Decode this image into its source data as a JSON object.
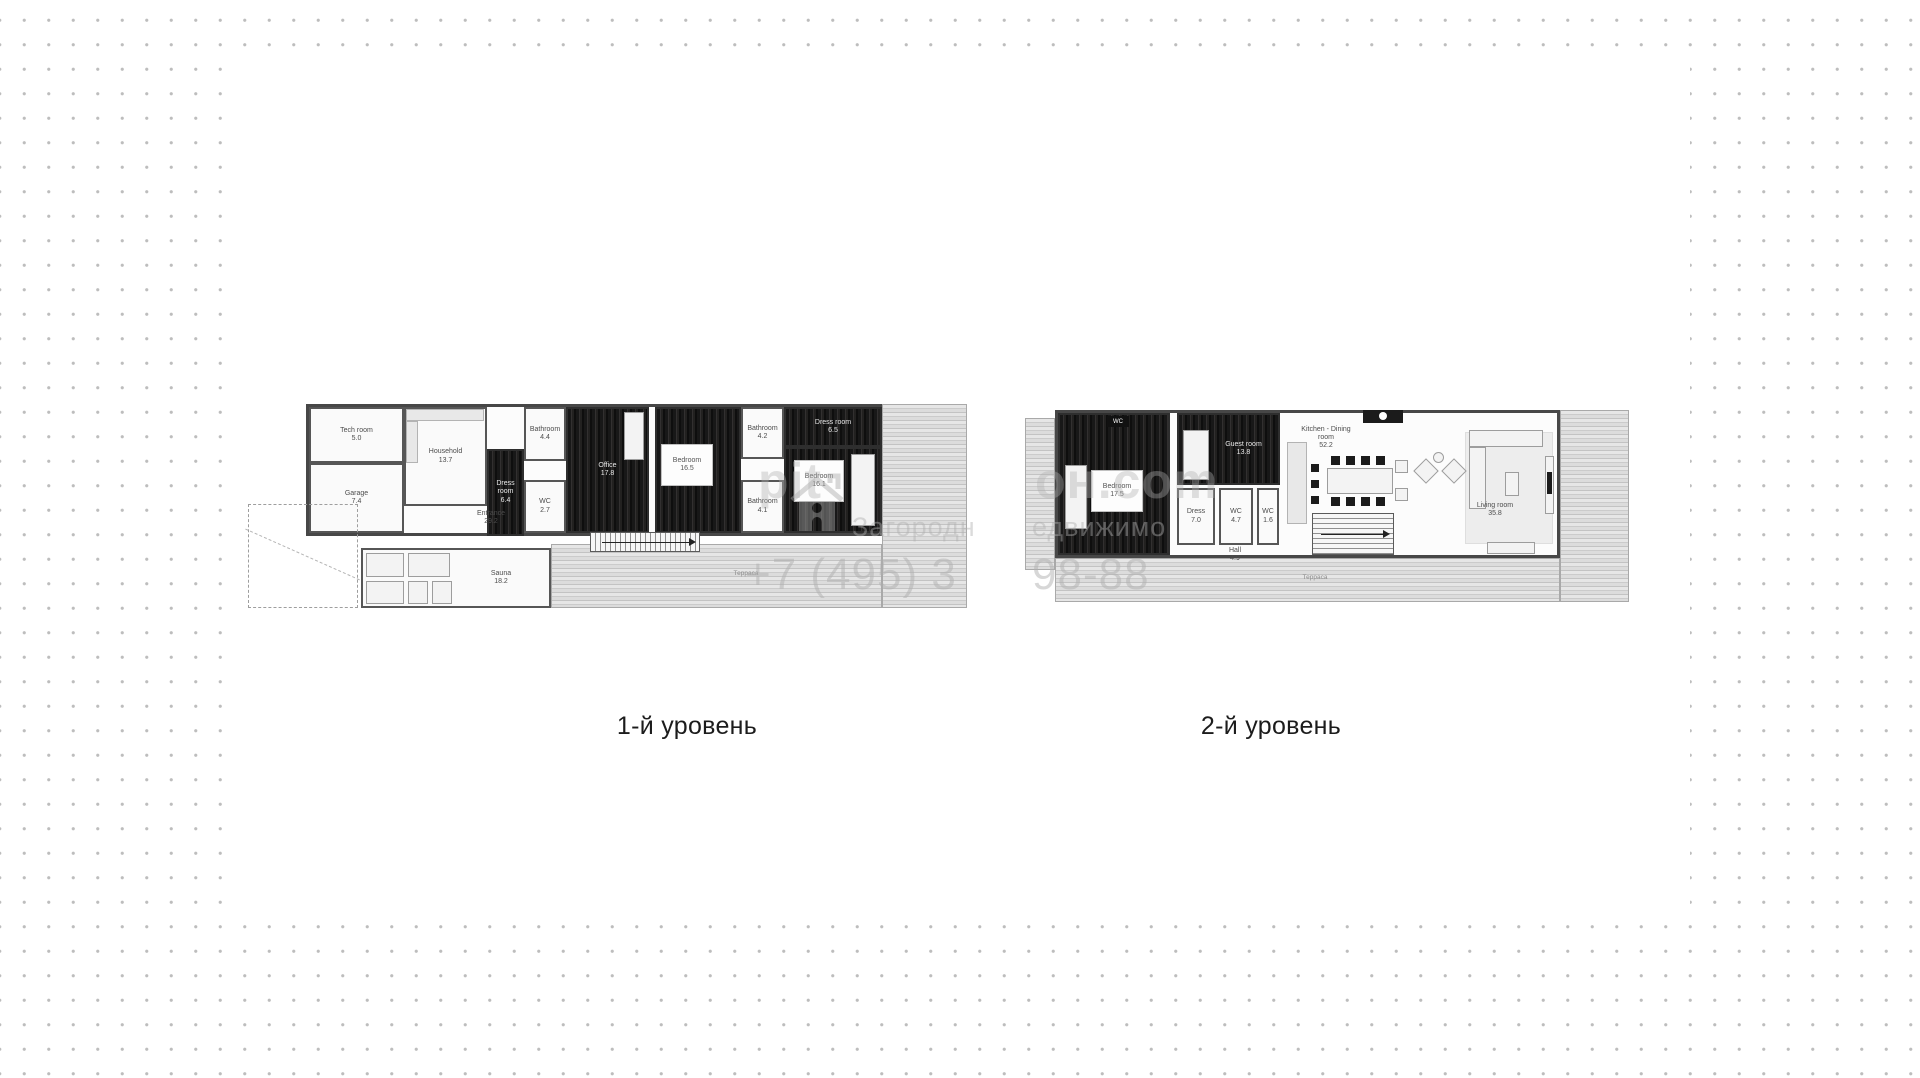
{
  "page": {
    "dot_color": "#bdbdbd",
    "card_color": "#ffffff",
    "card": {
      "x": 235,
      "y": 67,
      "w": 1455,
      "h": 858
    }
  },
  "levels": [
    {
      "label": "1-й уровень",
      "label_x": 687,
      "label_y": 712,
      "x": 306,
      "y": 404,
      "w": 661,
      "h": 206,
      "elements": [
        {
          "kind": "room",
          "style": "base",
          "x": 0,
          "y": 0,
          "w": 576,
          "h": 132,
          "name": "house-outline"
        },
        {
          "kind": "room",
          "style": "deck",
          "x": 576,
          "y": 0,
          "w": 85,
          "h": 204,
          "name": "terrace-right"
        },
        {
          "kind": "room",
          "style": "deck",
          "x": 245,
          "y": 140,
          "w": 331,
          "h": 64,
          "name": "terrace-bottom"
        },
        {
          "kind": "room",
          "style": "light",
          "x": 3,
          "y": 3,
          "w": 95,
          "h": 56,
          "label": "Tech room",
          "area": "5.0"
        },
        {
          "kind": "room",
          "style": "light",
          "x": 3,
          "y": 59,
          "w": 95,
          "h": 70,
          "label": "Garage",
          "area": "7.4"
        },
        {
          "kind": "room",
          "style": "light",
          "x": 98,
          "y": 3,
          "w": 83,
          "h": 99,
          "label": "Household",
          "area": "13.7"
        },
        {
          "kind": "furn",
          "shape": "counter",
          "x": 100,
          "y": 5,
          "w": 78,
          "h": 12
        },
        {
          "kind": "furn",
          "shape": "counter",
          "x": 100,
          "y": 17,
          "w": 12,
          "h": 42
        },
        {
          "kind": "room",
          "style": "dark",
          "x": 181,
          "y": 45,
          "w": 37,
          "h": 87,
          "label": "Dress room",
          "area": "6.4"
        },
        {
          "kind": "room",
          "style": "light",
          "x": 218,
          "y": 3,
          "w": 42,
          "h": 54,
          "label": "Bathroom",
          "area": "4.4"
        },
        {
          "kind": "room",
          "style": "light",
          "x": 218,
          "y": 76,
          "w": 42,
          "h": 53,
          "label": "WC",
          "area": "2.7"
        },
        {
          "kind": "room",
          "style": "dark",
          "x": 260,
          "y": 3,
          "w": 83,
          "h": 126,
          "label": "Office",
          "area": "17.8"
        },
        {
          "kind": "furn",
          "shape": "rect",
          "x": 318,
          "y": 8,
          "w": 20,
          "h": 48
        },
        {
          "kind": "room",
          "style": "dark",
          "x": 349,
          "y": 3,
          "w": 86,
          "h": 126,
          "name": "room-bedroom-2"
        },
        {
          "kind": "furn",
          "shape": "labelbox",
          "x": 355,
          "y": 40,
          "w": 52,
          "h": 42,
          "label": "Bedroom",
          "area": "16.5"
        },
        {
          "kind": "room",
          "style": "light",
          "x": 435,
          "y": 3,
          "w": 43,
          "h": 52,
          "label": "Bathroom",
          "area": "4.2"
        },
        {
          "kind": "room",
          "style": "light",
          "x": 435,
          "y": 76,
          "w": 43,
          "h": 53,
          "label": "Bathroom",
          "area": "4.1"
        },
        {
          "kind": "room",
          "style": "dark",
          "x": 478,
          "y": 3,
          "w": 98,
          "h": 40,
          "label": "Dress room",
          "area": "6.5"
        },
        {
          "kind": "room",
          "style": "dark",
          "x": 478,
          "y": 43,
          "w": 98,
          "h": 86,
          "name": "room-bedroom-1"
        },
        {
          "kind": "furn",
          "shape": "rect",
          "x": 545,
          "y": 50,
          "w": 24,
          "h": 72
        },
        {
          "kind": "furn",
          "shape": "labelbox",
          "x": 488,
          "y": 56,
          "w": 50,
          "h": 42,
          "label": "Bedroom",
          "area": "16.1"
        },
        {
          "kind": "label",
          "label": "Entrance",
          "area": "29.2",
          "x": 150,
          "y": 106,
          "w": 70
        },
        {
          "kind": "stairs",
          "dir": "v",
          "x": 284,
          "y": 128,
          "w": 110,
          "h": 20
        },
        {
          "kind": "room",
          "style": "light",
          "x": 55,
          "y": 144,
          "w": 190,
          "h": 60,
          "label": "Sauna",
          "area": "18.2",
          "pad": 90,
          "name": "room-sauna"
        },
        {
          "kind": "furn",
          "shape": "rect",
          "x": 60,
          "y": 149,
          "w": 38,
          "h": 24
        },
        {
          "kind": "furn",
          "shape": "rect",
          "x": 60,
          "y": 177,
          "w": 38,
          "h": 23
        },
        {
          "kind": "furn",
          "shape": "rect",
          "x": 102,
          "y": 149,
          "w": 42,
          "h": 24
        },
        {
          "kind": "furn",
          "shape": "rect",
          "x": 102,
          "y": 177,
          "w": 20,
          "h": 23
        },
        {
          "kind": "furn",
          "shape": "rect",
          "x": 126,
          "y": 177,
          "w": 20,
          "h": 23
        },
        {
          "kind": "dashed",
          "x": -58,
          "y": 100,
          "w": 110,
          "h": 104,
          "name": "driveway-outline"
        },
        {
          "kind": "zone-label",
          "label": "Терраса",
          "x": 400,
          "y": 166,
          "w": 80
        }
      ]
    },
    {
      "label": "2-й уровень",
      "label_x": 1271,
      "label_y": 712,
      "x": 1025,
      "y": 410,
      "w": 604,
      "h": 200,
      "elements": [
        {
          "kind": "room",
          "style": "deck",
          "x": 0,
          "y": 8,
          "w": 30,
          "h": 152,
          "name": "deck-left"
        },
        {
          "kind": "room",
          "style": "base",
          "x": 30,
          "y": 0,
          "w": 505,
          "h": 148,
          "name": "house-outline"
        },
        {
          "kind": "room",
          "style": "deck",
          "x": 535,
          "y": 0,
          "w": 69,
          "h": 192,
          "name": "deck-right"
        },
        {
          "kind": "room",
          "style": "deck",
          "x": 30,
          "y": 148,
          "w": 505,
          "h": 44,
          "name": "terrace-bottom"
        },
        {
          "kind": "room",
          "style": "dark",
          "x": 33,
          "y": 3,
          "w": 112,
          "h": 142,
          "name": "room-bedroom"
        },
        {
          "kind": "furn",
          "shape": "rect",
          "x": 40,
          "y": 55,
          "w": 22,
          "h": 64
        },
        {
          "kind": "furn",
          "shape": "labelbox",
          "x": 66,
          "y": 60,
          "w": 52,
          "h": 42,
          "label": "Bedroom",
          "area": "17.5"
        },
        {
          "kind": "tag",
          "label": "WC",
          "x": 82,
          "y": 6,
          "w": 22,
          "h": 11
        },
        {
          "kind": "room",
          "style": "dark",
          "x": 152,
          "y": 3,
          "w": 103,
          "h": 72,
          "label": "Guest room",
          "area": "13.8",
          "pad": 30
        },
        {
          "kind": "furn",
          "shape": "rect",
          "x": 158,
          "y": 20,
          "w": 26,
          "h": 50
        },
        {
          "kind": "room",
          "style": "light",
          "x": 152,
          "y": 78,
          "w": 38,
          "h": 57,
          "label": "Dress",
          "area": "7.0"
        },
        {
          "kind": "room",
          "style": "light",
          "x": 194,
          "y": 78,
          "w": 34,
          "h": 57,
          "label": "WC",
          "area": "4.7"
        },
        {
          "kind": "room",
          "style": "light",
          "x": 232,
          "y": 78,
          "w": 22,
          "h": 57,
          "label": "WC",
          "area": "1.6"
        },
        {
          "kind": "label",
          "label": "Hall",
          "area": "4.9",
          "x": 185,
          "y": 137,
          "w": 50
        },
        {
          "kind": "label",
          "label": "Kitchen - Dining room",
          "area": "52.2",
          "x": 268,
          "y": 16,
          "w": 66,
          "name": "label-kitchen-dining-room"
        },
        {
          "kind": "furn",
          "shape": "counter",
          "x": 262,
          "y": 32,
          "w": 20,
          "h": 82
        },
        {
          "kind": "furn",
          "shape": "black",
          "x": 286,
          "y": 54,
          "w": 8,
          "h": 8
        },
        {
          "kind": "furn",
          "shape": "black",
          "x": 286,
          "y": 70,
          "w": 8,
          "h": 8
        },
        {
          "kind": "furn",
          "shape": "black",
          "x": 286,
          "y": 86,
          "w": 8,
          "h": 8
        },
        {
          "kind": "furn",
          "shape": "rect",
          "x": 302,
          "y": 58,
          "w": 66,
          "h": 26
        },
        {
          "kind": "furn",
          "shape": "black",
          "x": 306,
          "y": 46,
          "w": 9,
          "h": 9
        },
        {
          "kind": "furn",
          "shape": "black",
          "x": 321,
          "y": 46,
          "w": 9,
          "h": 9
        },
        {
          "kind": "furn",
          "shape": "black",
          "x": 336,
          "y": 46,
          "w": 9,
          "h": 9
        },
        {
          "kind": "furn",
          "shape": "black",
          "x": 351,
          "y": 46,
          "w": 9,
          "h": 9
        },
        {
          "kind": "furn",
          "shape": "black",
          "x": 306,
          "y": 87,
          "w": 9,
          "h": 9
        },
        {
          "kind": "furn",
          "shape": "black",
          "x": 321,
          "y": 87,
          "w": 9,
          "h": 9
        },
        {
          "kind": "furn",
          "shape": "black",
          "x": 336,
          "y": 87,
          "w": 9,
          "h": 9
        },
        {
          "kind": "furn",
          "shape": "black",
          "x": 351,
          "y": 87,
          "w": 9,
          "h": 9
        },
        {
          "kind": "furn",
          "shape": "rect",
          "x": 370,
          "y": 50,
          "w": 13,
          "h": 13
        },
        {
          "kind": "furn",
          "shape": "rect",
          "x": 370,
          "y": 78,
          "w": 13,
          "h": 13
        },
        {
          "kind": "furn",
          "shape": "black",
          "x": 338,
          "y": 0,
          "w": 40,
          "h": 13,
          "name": "fireplace"
        },
        {
          "kind": "furn",
          "shape": "rwhite",
          "x": 354,
          "y": 2,
          "w": 8,
          "h": 8
        },
        {
          "kind": "furn",
          "shape": "rot",
          "x": 392,
          "y": 52,
          "w": 18,
          "h": 18
        },
        {
          "kind": "furn",
          "shape": "rot",
          "x": 420,
          "y": 52,
          "w": 18,
          "h": 18
        },
        {
          "kind": "furn",
          "shape": "round",
          "x": 408,
          "y": 42,
          "w": 11,
          "h": 11
        },
        {
          "kind": "stairs",
          "dir": "h",
          "x": 287,
          "y": 103,
          "w": 82,
          "h": 42
        },
        {
          "kind": "furn",
          "shape": "rug",
          "x": 440,
          "y": 22,
          "w": 88,
          "h": 112
        },
        {
          "kind": "furn",
          "shape": "rect",
          "x": 444,
          "y": 20,
          "w": 74,
          "h": 17
        },
        {
          "kind": "furn",
          "shape": "rect",
          "x": 444,
          "y": 37,
          "w": 17,
          "h": 62
        },
        {
          "kind": "furn",
          "shape": "rect",
          "x": 480,
          "y": 62,
          "w": 14,
          "h": 24
        },
        {
          "kind": "furn",
          "shape": "rect",
          "x": 520,
          "y": 46,
          "w": 9,
          "h": 58
        },
        {
          "kind": "furn",
          "shape": "black",
          "x": 522,
          "y": 62,
          "w": 5,
          "h": 22
        },
        {
          "kind": "furn",
          "shape": "rect",
          "x": 462,
          "y": 132,
          "w": 48,
          "h": 12
        },
        {
          "kind": "label",
          "label": "Living room",
          "area": "35.8",
          "x": 440,
          "y": 92,
          "w": 60
        },
        {
          "kind": "zone-label",
          "label": "Терраса",
          "x": 250,
          "y": 164,
          "w": 80
        }
      ]
    }
  ],
  "watermark": {
    "logo_icon": "house-logo-icon",
    "fragments": [
      {
        "text": "pit",
        "x": 758,
        "y": 452,
        "size": 50,
        "weight": 700,
        "opacity": 0.38
      },
      {
        "text": "он.com",
        "x": 1035,
        "y": 452,
        "size": 50,
        "weight": 700,
        "opacity": 0.38
      },
      {
        "text": "Загородн",
        "x": 852,
        "y": 512,
        "size": 27,
        "weight": 400,
        "opacity": 0.45
      },
      {
        "text": "едвижимо",
        "x": 1032,
        "y": 512,
        "size": 27,
        "weight": 400,
        "opacity": 0.45
      },
      {
        "text": "+7 (495) 3",
        "x": 745,
        "y": 550,
        "size": 44,
        "weight": 400,
        "opacity": 0.5
      },
      {
        "text": "98-88",
        "x": 1032,
        "y": 550,
        "size": 44,
        "weight": 400,
        "opacity": 0.5
      }
    ]
  }
}
